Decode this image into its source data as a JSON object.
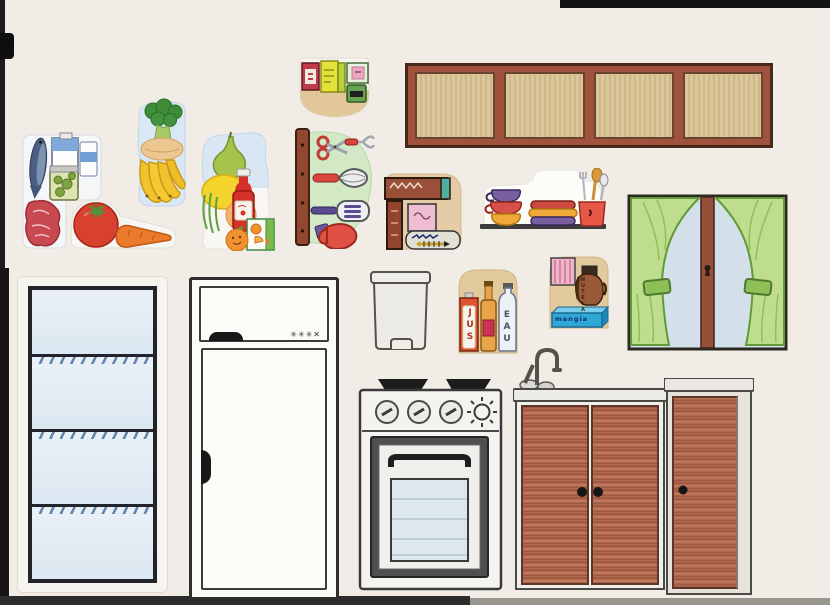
{
  "scene": {
    "kind": "Scanned sheet of hand-drawn paper kitchen cutouts",
    "background": "#f1ede6"
  },
  "labels": {
    "juice_carton": "JUS",
    "water_bottle": "EAU",
    "spread_jar": "NUTELA",
    "blue_box": "mangia",
    "freezer_marks": "✳✳✳✕"
  },
  "cutouts": [
    {
      "id": "pantry-shelf-cutout",
      "name": "shelf with packaged food boxes and can"
    },
    {
      "id": "upper-cabinet",
      "name": "long wall cabinet with four wood panels"
    },
    {
      "id": "fridge-food-cutout",
      "name": "fish, milk, yogurt, pickle jar and steak"
    },
    {
      "id": "broccoli-banana-cutout",
      "name": "broccoli, bread and banana bunch"
    },
    {
      "id": "pear-lemon-cutout",
      "name": "pear, lemon, peach, ketchup and juice box"
    },
    {
      "id": "utensil-rack-cutout",
      "name": "rack with scissors, fork, whisk, spatula and oven mitt"
    },
    {
      "id": "tomato-carrot-cutout",
      "name": "tomato and carrot"
    },
    {
      "id": "cookbook-shelf-cutout",
      "name": "books, pink box and sardine can"
    },
    {
      "id": "dishes-shelf-cutout",
      "name": "stacked bowls, dishes and utensil pot"
    },
    {
      "id": "window-curtains",
      "name": "window with green tied-back curtains"
    },
    {
      "id": "trash-can",
      "name": "pedal trash bin"
    },
    {
      "id": "drinks-cutout",
      "name": "juice carton, oil bottle and water bottle"
    },
    {
      "id": "spread-shelf-cutout",
      "name": "striped package, spread jar and blue box"
    },
    {
      "id": "open-shelf-unit",
      "name": "open unit with four blue shelves"
    },
    {
      "id": "white-fridge",
      "name": "refrigerator with freezer door"
    },
    {
      "id": "stove",
      "name": "stove with burners, knobs and oven window"
    },
    {
      "id": "sink-cabinet",
      "name": "sink cabinet with faucet and double wood doors"
    },
    {
      "id": "side-cabinet",
      "name": "single-door wood cabinet"
    }
  ],
  "colors": {
    "cabinet_frame": "#a0523d",
    "cabinet_panel": "#d8c298",
    "door_wood": "#b26a4f",
    "curtain_green": "#bedd8e",
    "window_pane": "#d3dfe9",
    "shelf_blue": "#e2ecf4",
    "utensil_bg_green": "#d3e9c5",
    "cutout_tan": "#e3ca9d"
  }
}
